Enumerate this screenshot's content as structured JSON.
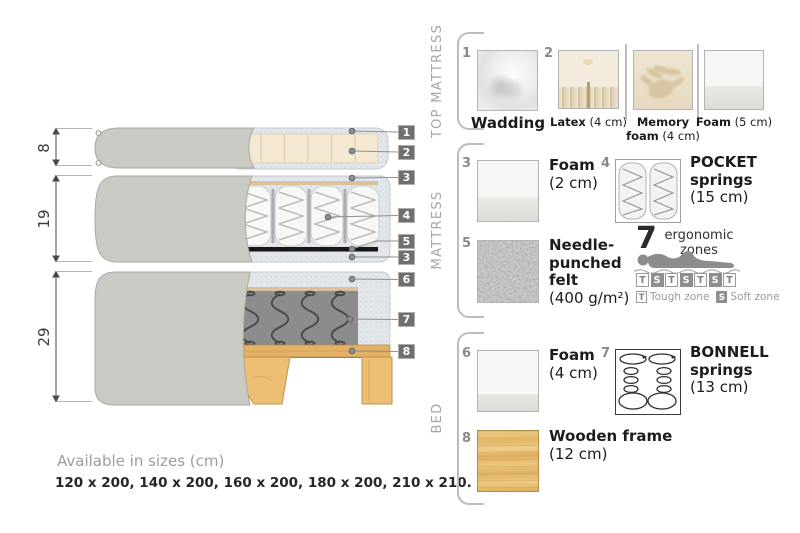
{
  "diagram": {
    "dim_labels": [
      "8",
      "19",
      "29"
    ],
    "callouts": [
      "1",
      "2",
      "3",
      "4",
      "5",
      "3",
      "6",
      "7",
      "8"
    ],
    "sizes": {
      "title": "Available in sizes (cm)",
      "values": "120 x 200, 140 x 200, 160 x 200, 180 x 200, 210 x 210."
    }
  },
  "sections": {
    "top_mattress": {
      "label": "TOP MATTRESS",
      "items": [
        {
          "num": "1",
          "title": "Wadding",
          "detail": ""
        },
        {
          "num": "2",
          "title": "Latex",
          "detail": "(4 cm)"
        },
        {
          "num": "",
          "title": "Memory foam",
          "detail": "(4 cm)"
        },
        {
          "num": "",
          "title": "Foam",
          "detail": "(5 cm)"
        }
      ]
    },
    "mattress": {
      "label": "MATTRESS",
      "items": [
        {
          "num": "3",
          "title": "Foam",
          "detail": "(2 cm)"
        },
        {
          "num": "4",
          "title": "POCKET springs",
          "detail": "(15 cm)"
        },
        {
          "num": "5",
          "title": "Needle-punched felt",
          "detail": "(400 g/m²)"
        }
      ],
      "ergonomic": {
        "count": "7",
        "caption": "ergonomic zones",
        "zones": [
          "T",
          "S",
          "T",
          "S",
          "T",
          "S",
          "T"
        ],
        "legend": [
          {
            "key": "T",
            "label": "Tough zone"
          },
          {
            "key": "S",
            "label": "Soft zone"
          }
        ]
      }
    },
    "bed": {
      "label": "BED",
      "items": [
        {
          "num": "6",
          "title": "Foam",
          "detail": "(4 cm)"
        },
        {
          "num": "7",
          "title": "BONNELL springs",
          "detail": "(13 cm)"
        },
        {
          "num": "8",
          "title": "Wooden frame",
          "detail": "(12 cm)"
        }
      ]
    }
  }
}
